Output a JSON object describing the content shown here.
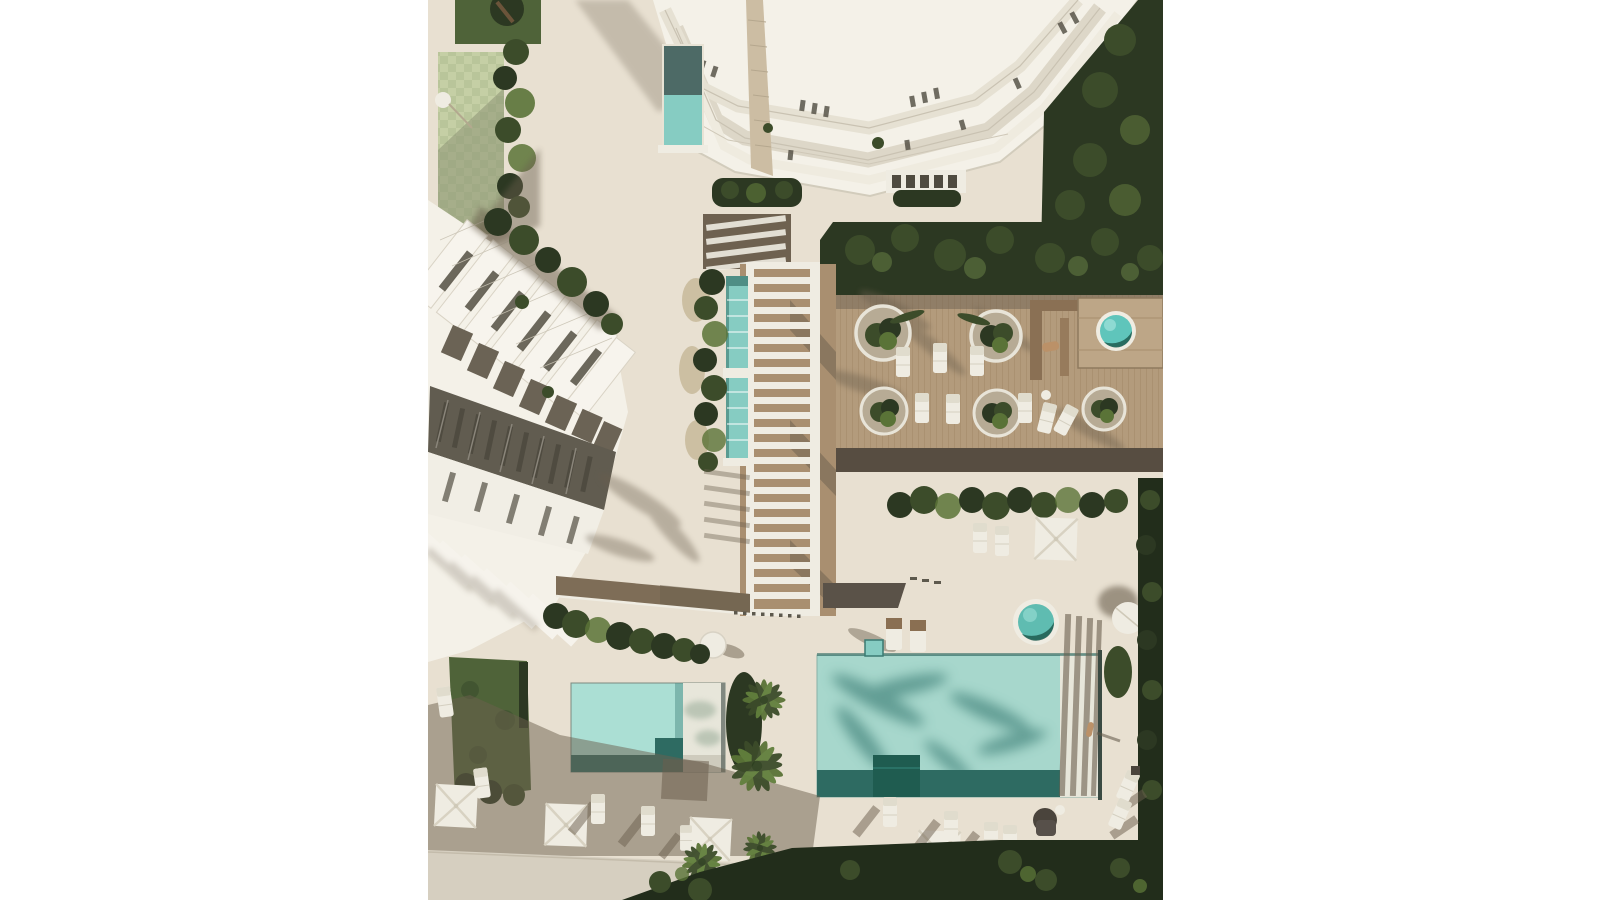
{
  "scene": {
    "type": "aerial-architectural-render",
    "description": "Top-down 3D architectural rendering of a coastal residential resort: a faceted white tower at top, a row of white townhouses at left, a slatted pergola walkway in the centre, a timber amenity deck with round planters and a hot tub at right, and four turquoise pools surrounded by sun loungers, square parasols, palm trees and hedges on sand-coloured paving, with white margins left and right.",
    "objects": [
      "white-tower-building",
      "townhouse-building",
      "pergola-walkway",
      "timber-deck",
      "lap-pool",
      "tower-pool",
      "main-pool",
      "kids-pool",
      "plunge-pool",
      "hot-tub",
      "round-planters",
      "sun-loungers",
      "square-parasols",
      "palm-trees",
      "hedges",
      "lawn-checkered",
      "lawn-dark",
      "brown-footpath",
      "sunbather",
      "standing-person"
    ],
    "palette": {
      "white": "#ffffff",
      "pave": "#e8e0d1",
      "walk": "#d6cfc0",
      "warm-shadow": "#6b5f4e",
      "wood": "#b39b7c",
      "wood-line": "#9f8766",
      "wood-dark": "#574d41",
      "brown-path": "#7e6d57",
      "bldg-white": "#f4f1e8",
      "offwhite": "#efece2",
      "glass": "#ded8c9",
      "win-dark": "#4f4b40",
      "slab-gap": "#5d594d",
      "dark-band": "#615c50",
      "trunk-tan": "#ccbda3",
      "hedge-d": "#2c3822",
      "hedge-m": "#3c4c2a",
      "hedge-l": "#5a7337",
      "veg-deep": "#222d1b",
      "lawn-l": "#c5cfa5",
      "lawn-l2": "#b9c59a",
      "lawn-d": "#4f6339",
      "pool-l": "#a7d7cc",
      "pool-lap": "#86ccc2",
      "pool-d": "#2e6b62",
      "pool-sh": "#4f8e85",
      "pool-deep": "#1f5c50",
      "shelf": "#e7e6da",
      "hot": "#5fc5bb",
      "person": "#bb9168"
    }
  }
}
